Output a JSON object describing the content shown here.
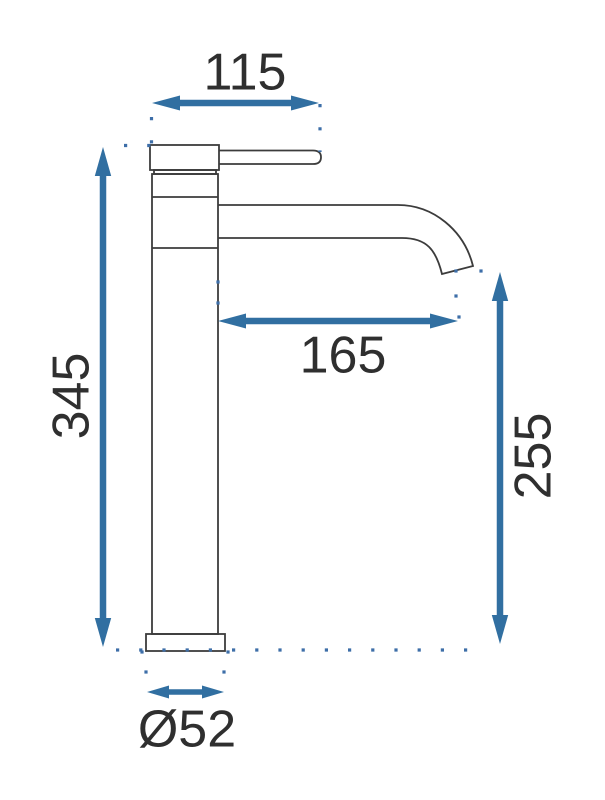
{
  "diagram": {
    "type": "technical-dimension-drawing",
    "subject": "tall single-lever basin faucet, side view",
    "dimensions": {
      "handle_width": {
        "value": "115",
        "meaning": "width across lever/handle at top"
      },
      "total_height": {
        "value": "345",
        "meaning": "overall height of faucet body"
      },
      "spout_reach": {
        "value": "165",
        "meaning": "horizontal reach from body to spout outlet"
      },
      "spout_height": {
        "value": "255",
        "meaning": "height from base plane to spout outlet"
      },
      "base_diameter": {
        "value": "Ø52",
        "meaning": "diameter of mounting base"
      }
    }
  },
  "colors": {
    "dimension": "#316fa1",
    "dot": "#3d6ea8",
    "outline": "#3c3c3c",
    "text": "#2f2f2f",
    "background": "#ffffff"
  }
}
